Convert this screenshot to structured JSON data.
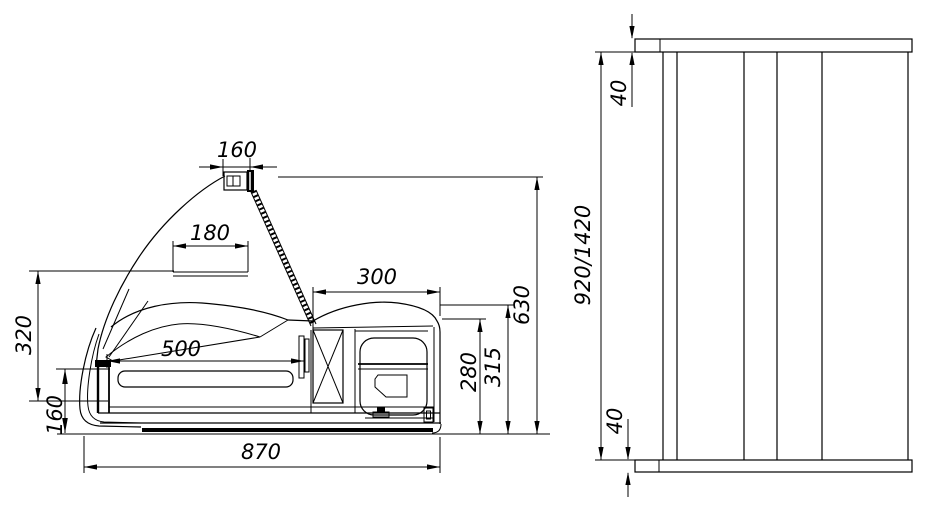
{
  "colors": {
    "line": "#000000",
    "background": "#ffffff"
  },
  "side_view": {
    "dim_lamp_width": "160",
    "dim_header_box_width": "180",
    "dim_machine_compartment_width": "300",
    "dim_display_depth": "500",
    "dim_glass_height": "320",
    "dim_front_panel_height": "160",
    "dim_overall_depth": "870",
    "dim_compartment_height": "280",
    "dim_worktop_height": "315",
    "dim_overall_height": "630"
  },
  "front_view": {
    "dim_top_panel_thickness": "40",
    "dim_column_height": "920/1420",
    "dim_bottom_panel_thickness": "40"
  }
}
